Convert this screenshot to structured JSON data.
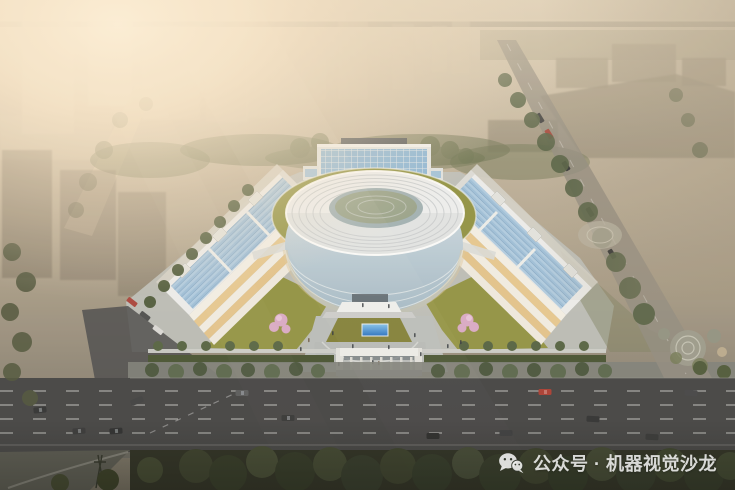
{
  "watermark": {
    "icon": "wechat",
    "text": "公众号 · 机器视觉沙龙"
  },
  "palette": {
    "glow": "#f7e6c6",
    "sky_top": "#d8cbb4",
    "sky_right": "#a89b86",
    "ring_roof": "#edeff0",
    "ring_shadow": "#c7cccf",
    "glass_light": "#d8e4ea",
    "glass_dark": "#9fb6c5",
    "tower_glass": "#8ab6d8",
    "solar_blue": "#a2c3dc",
    "green_roof": "#8f9140",
    "lawn": "#7d7c33",
    "pond_blue": "#2f7fd2",
    "blossom_pink": "#d8a9c6",
    "tree_green": "#45523a",
    "tree_dark": "#333a26",
    "road_gray": "#3e3f41",
    "pavement": "#b8bcbb",
    "warm_floor": "#e5c78f",
    "white_struct": "#eceded",
    "watermark_color": "rgba(255,255,255,0.82)"
  }
}
